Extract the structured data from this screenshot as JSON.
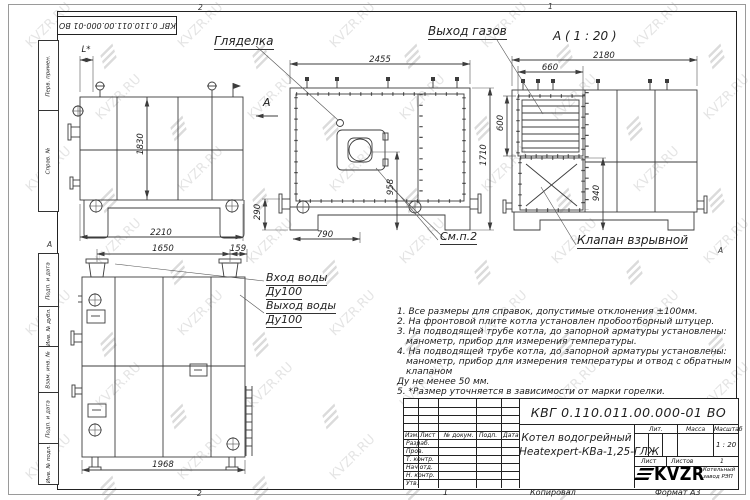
{
  "watermark": {
    "text": "KVZR.RU"
  },
  "sheet": {
    "stamp_top": "КВГ 0.110.011.00.000-01 ВО",
    "side_columns": [
      "Перв. примен.",
      "Справ. №",
      "Подп. и дата",
      "Инв. № дубл.",
      "Взам. инв. №",
      "Подп. и дата",
      "Инв. № подл."
    ],
    "zone_top_left": "2",
    "zone_top_right": "1",
    "zone_bottom_left": "2",
    "zone_bottom_right": "1",
    "zone_row_left": "А",
    "zone_row_right": "А"
  },
  "labels": {
    "sight_glass": "Гляделка",
    "gas_outlet": "Выход газов",
    "view_a_title": "А ( 1 : 20 )",
    "view_a_arrow": "А",
    "explosion_valve": "Клапан взрывной",
    "see_item": "См.п.2",
    "water_in": "Вход воды",
    "water_in_dn": "Ду100",
    "water_out": "Выход воды",
    "water_out_dn": "Ду100"
  },
  "dimensions": {
    "side_l": "L*",
    "side_height": "1830",
    "side_width": "2210",
    "front_width": "2455",
    "front_height": "1710",
    "burner_axis_x": "790",
    "burner_axis_h": "958",
    "pipe_h": "290",
    "rear_width": "2180",
    "louver_width": "660",
    "louver_height": "600",
    "valve_h": "940",
    "plan_w1": "1650",
    "plan_w2": "159",
    "plan_width": "1968"
  },
  "notes": [
    "1. Все размеры для справок, допустимые отклонения ±100мм.",
    "2. На фронтовой плите котла установлен пробоотборный штуцер.",
    "3. На подводящей трубе котла, до запорной арматуры установлены:",
    "манометр, прибор для измерения температуры.",
    "4. На подводящей трубе котла, до запорной арматуры установлены:",
    "манометр, прибор для измерения температуры и отвод с обратным клапаном",
    "Ду не менее 50 мм.",
    "5. *Размер уточняется в зависимости от марки горелки."
  ],
  "title_block": {
    "doc_number": "КВГ 0.110.011.00.000-01 ВО",
    "name_line1": "Котел водогрейный",
    "name_line2": "Heatexpert-КВа-1,25-ГЛЖ",
    "cols": {
      "izm": "Изм.",
      "list": "Лист",
      "doc": "№ докум.",
      "podp": "Подп.",
      "data": "Дата"
    },
    "rows": [
      "Разраб.",
      "Пров.",
      "Т. контр.",
      "Нач.отд.",
      "Н. контр.",
      "Утв."
    ],
    "lit": "Лит.",
    "mass": "Масса",
    "scale_label": "Масштаб",
    "scale": "1 : 20",
    "sheet_label": "Лист",
    "sheets_label": "Листов",
    "sheets_value": "1",
    "brand": "KVZR",
    "brand_sub1": "Котельный",
    "brand_sub2": "завод РЭП"
  },
  "footer": {
    "zone": "1",
    "copied": "Копировал",
    "format": "Формат А3"
  }
}
